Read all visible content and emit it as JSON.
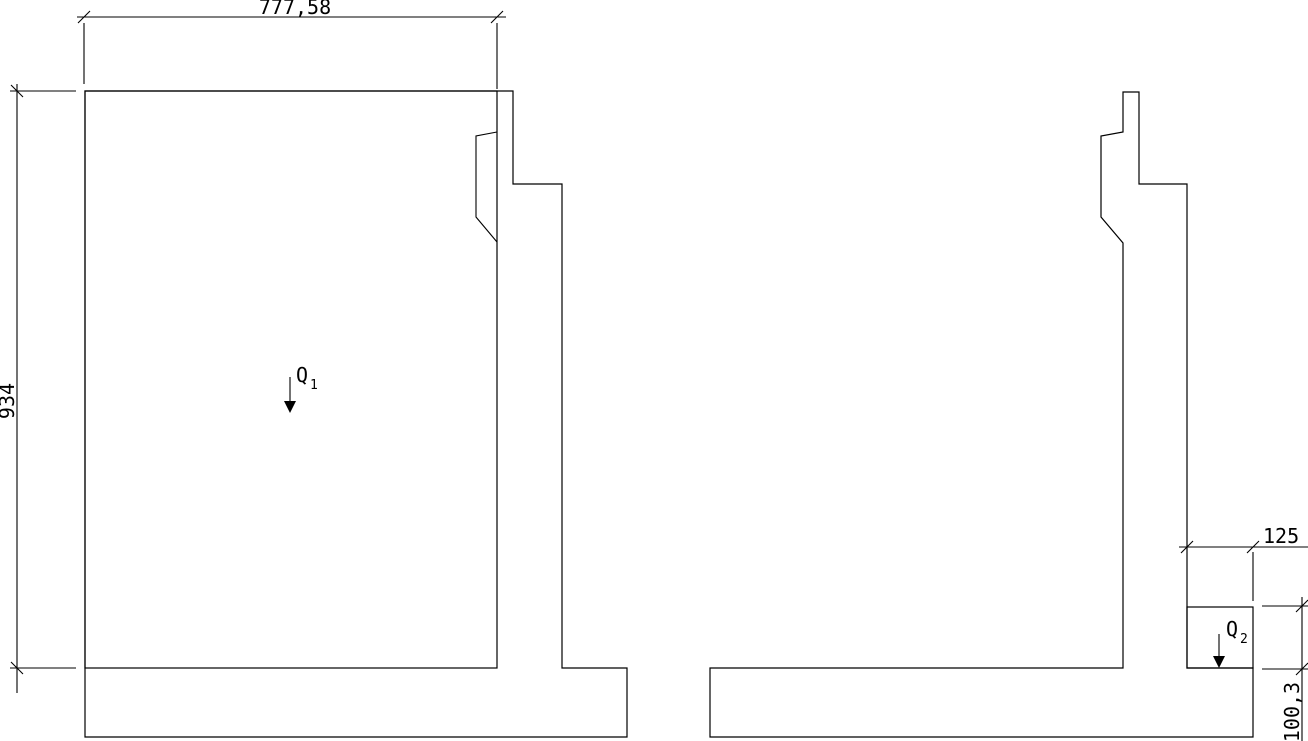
{
  "drawing": {
    "background_color": "#ffffff",
    "line_color": "#000000",
    "left_figure": {
      "description": "retaining wall cross-section with stippled backfill block",
      "width_dim_label": "777,58",
      "height_dim_label": "934",
      "load_label": "Q",
      "load_subscript": "1"
    },
    "right_figure": {
      "description": "retaining wall cross-section with stippled toe soil block",
      "width_dim_label": "125",
      "height_dim_label": "100,3",
      "load_label": "Q",
      "load_subscript": "2"
    }
  }
}
